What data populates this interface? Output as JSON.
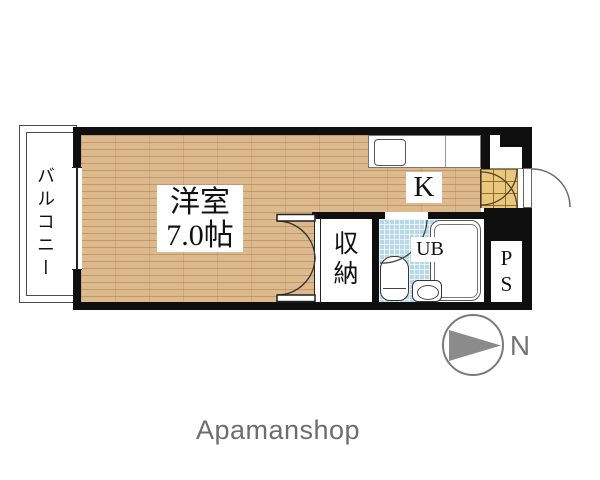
{
  "floor_plan": {
    "balcony": {
      "label": "バルコニー"
    },
    "main_room": {
      "name": "洋室",
      "size": "7.0帖"
    },
    "kitchen": {
      "label": "K"
    },
    "closet": {
      "label": "収納"
    },
    "unit_bath": {
      "label": "UB"
    },
    "pipe_space": {
      "line1": "P",
      "line2": "S"
    },
    "compass": {
      "north_label": "N"
    },
    "colors": {
      "wall": "#0f0f0f",
      "wood_floor": "#dcba8e",
      "bath_tile": "#b7d8e7",
      "entry_tile": "#e9c77b",
      "compass_gray": "#8b8b8b"
    }
  },
  "watermark": {
    "brand": "Apamanshop"
  }
}
